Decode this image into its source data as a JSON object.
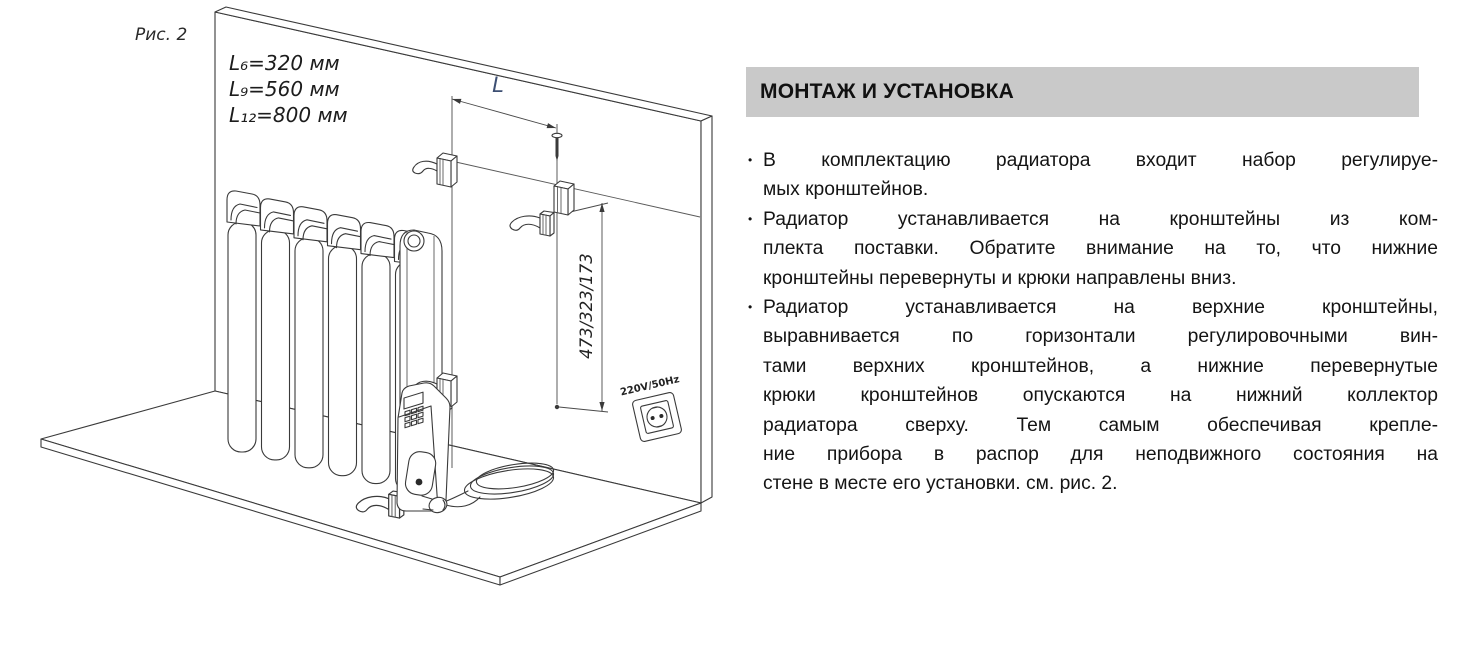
{
  "figure": {
    "caption": "Рис. 2",
    "legend": [
      "L₆=320 мм",
      "L₉=560 мм",
      "L₁₂=800 мм"
    ],
    "dim_horizontal": "L",
    "dim_vertical": "473/323/173",
    "outlet_label": "220V/50Hz"
  },
  "section": {
    "title": "МОНТАЖ И УСТАНОВКА",
    "bullet_char": "•",
    "bullets": [
      {
        "lines": [
          "В комплектацию радиатора входит набор регулируе-",
          "мых кронштейнов."
        ]
      },
      {
        "lines": [
          "Радиатор устанавливается на кронштейны из ком-",
          "плекта поставки. Обратите внимание на то, что нижние",
          "кронштейны перевернуты и крюки направлены вниз."
        ]
      },
      {
        "lines": [
          "Радиатор устанавливается на верхние кронштейны,",
          "выравнивается по горизонтали регулировочными вин-",
          "тами верхних кронштейнов, а нижние перевернутые",
          "крюки кронштейнов опускаются на нижний коллектор",
          "радиатора сверху. Тем самым обеспечивая крепле-",
          "ние прибора в распор для неподвижного состояния на",
          "стене в месте его установки. см. рис. 2."
        ]
      }
    ]
  },
  "colors": {
    "banner_bg": "#c9c9c9",
    "line_art": "#3a3a3a",
    "dim_label": "#3d4f73",
    "text": "#141414"
  }
}
